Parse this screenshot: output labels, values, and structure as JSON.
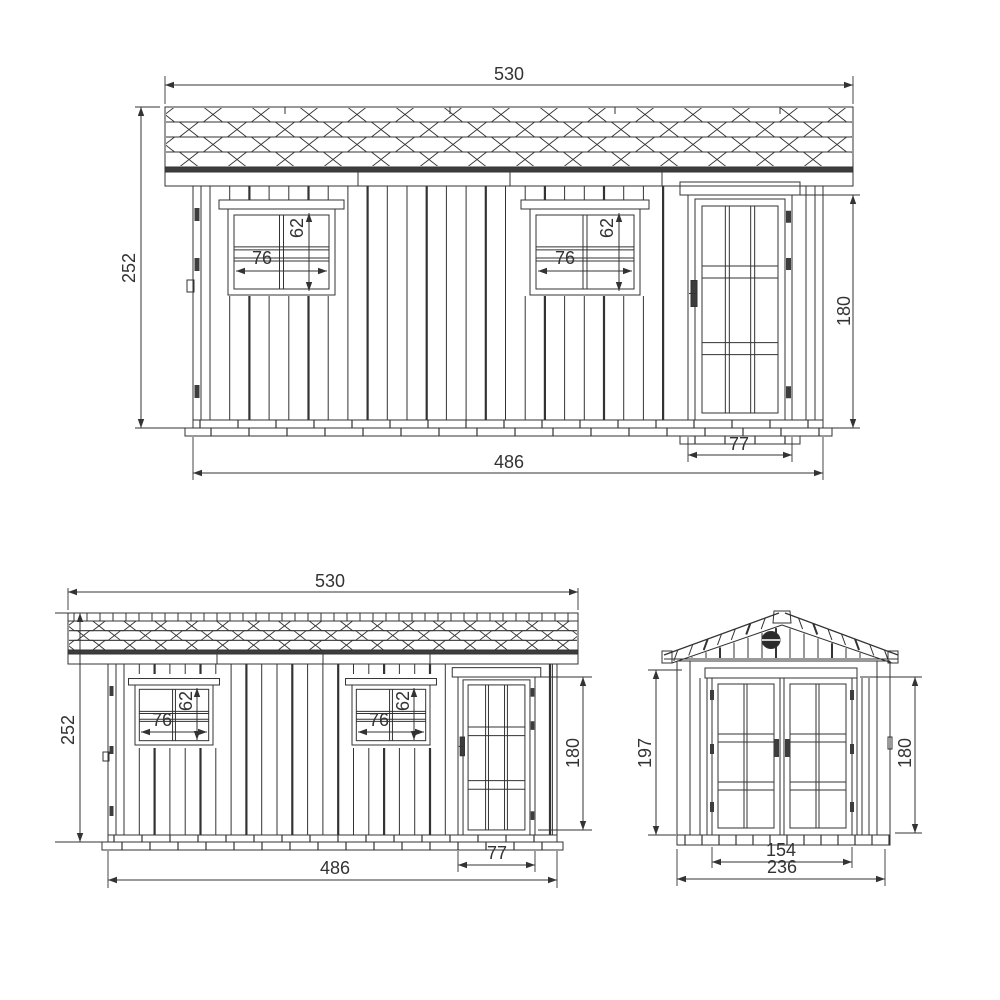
{
  "drawing": {
    "title": "garden-shed-technical-drawing",
    "colors": {
      "background": "#ffffff",
      "line": "#333333",
      "dark_fill": "#3d3d3d"
    },
    "views": {
      "front_large": {
        "name": "front-elevation-large",
        "dims": {
          "roof_width": "530",
          "wall_height": "252",
          "window1_height": "62",
          "window1_width": "76",
          "window2_height": "62",
          "window2_width": "76",
          "door_width": "77",
          "door_height": "180",
          "base_width": "486"
        }
      },
      "front_small": {
        "name": "front-elevation-small",
        "dims": {
          "roof_width": "530",
          "wall_height": "252",
          "window1_height": "62",
          "window1_width": "76",
          "window2_height": "62",
          "window2_width": "76",
          "door_width": "77",
          "door_height": "180",
          "base_width": "486"
        }
      },
      "gable": {
        "name": "gable-end-elevation",
        "dims": {
          "wall_height": "197",
          "door_height": "180",
          "doors_width": "154",
          "overall_width": "236"
        }
      }
    }
  }
}
